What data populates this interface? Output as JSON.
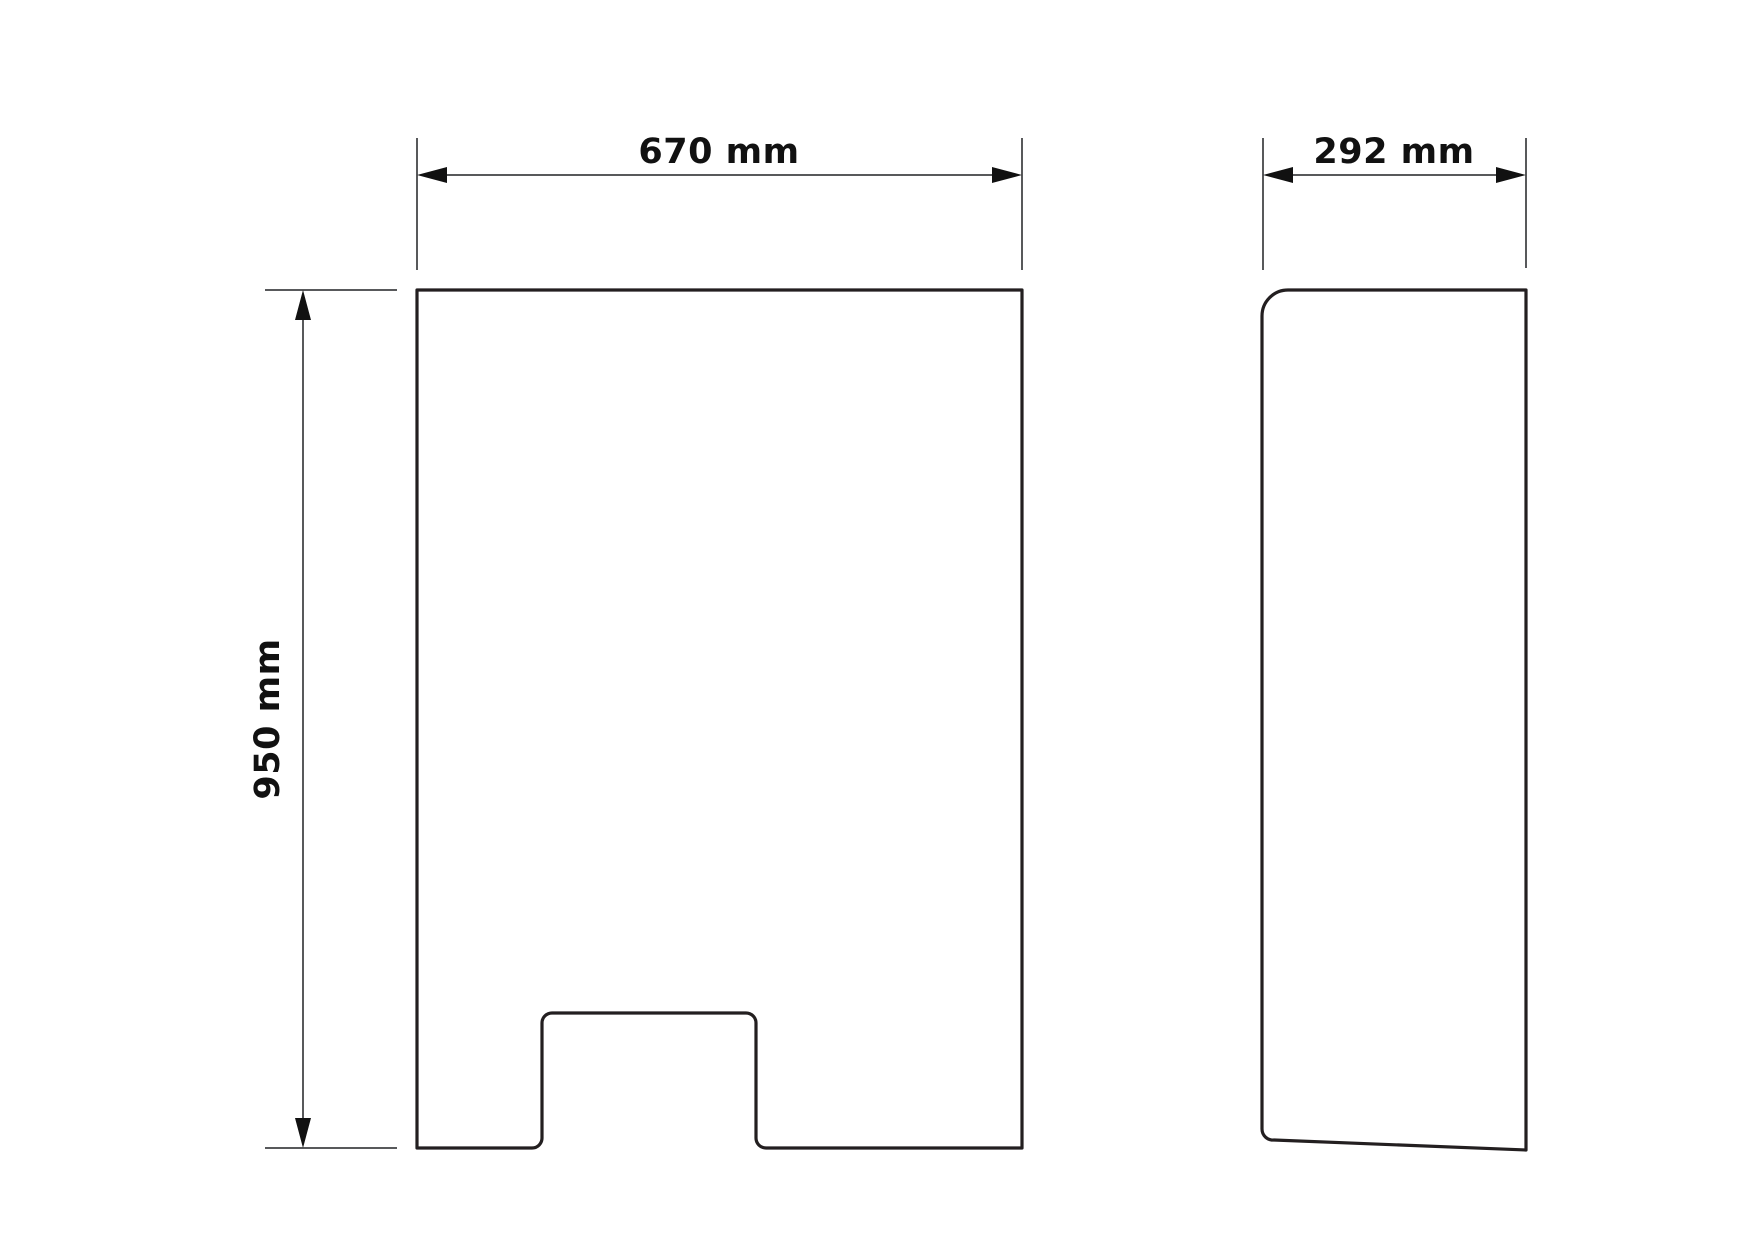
{
  "drawing": {
    "type": "technical-dimension-drawing",
    "units": "mm",
    "front_view": {
      "width_label": "670 mm",
      "height_label": "950 mm"
    },
    "side_view": {
      "depth_label": "292 mm"
    },
    "colors": {
      "outline": "#231f20",
      "dimension": "#58595b",
      "arrow": "#111111",
      "text": "#111111",
      "background": "#ffffff"
    }
  }
}
